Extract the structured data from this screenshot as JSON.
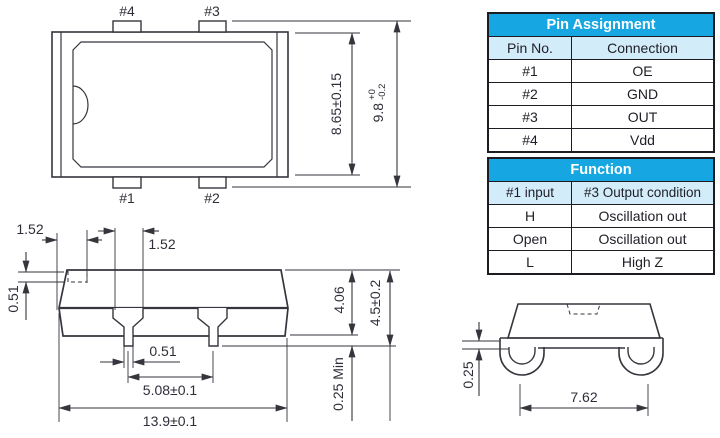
{
  "drawing": {
    "top_view": {
      "pins": {
        "p1": "#1",
        "p2": "#2",
        "p3": "#3",
        "p4": "#4"
      },
      "dims": {
        "body_width": "8.65±0.15",
        "overall_width_value": "9.8",
        "overall_width_tol_upper": "+0",
        "overall_width_tol_lower": "-0.2"
      }
    },
    "side_view": {
      "dims": {
        "corner_offset": "1.52",
        "lead_root_width": "1.52",
        "corner_step": "0.51",
        "pin_width": "0.51",
        "lead_pitch": "5.08±0.1",
        "overall_length": "13.9±0.1",
        "body_height": "4.06",
        "overall_height": "4.5±0.2",
        "standoff": "0.25 Min"
      }
    },
    "end_view": {
      "dims": {
        "lead_thickness": "0.25",
        "lead_span": "7.62"
      }
    }
  },
  "pin_assignment_table": {
    "title": "Pin Assignment",
    "columns": [
      "Pin No.",
      "Connection"
    ],
    "rows": [
      [
        "#1",
        "OE"
      ],
      [
        "#2",
        "GND"
      ],
      [
        "#3",
        "OUT"
      ],
      [
        "#4",
        "Vdd"
      ]
    ]
  },
  "function_table": {
    "title": "Function",
    "columns": [
      "#1 input",
      "#3 Output condition"
    ],
    "rows": [
      [
        "H",
        "Oscillation out"
      ],
      [
        "Open",
        "Oscillation out"
      ],
      [
        "L",
        "High Z"
      ]
    ]
  },
  "colors": {
    "table_header_bg": "#16a7e2",
    "table_subheader_bg": "#d3ecfa",
    "table_border": "#1c1c22",
    "line": "#35353d",
    "text": "#2e2e38"
  }
}
